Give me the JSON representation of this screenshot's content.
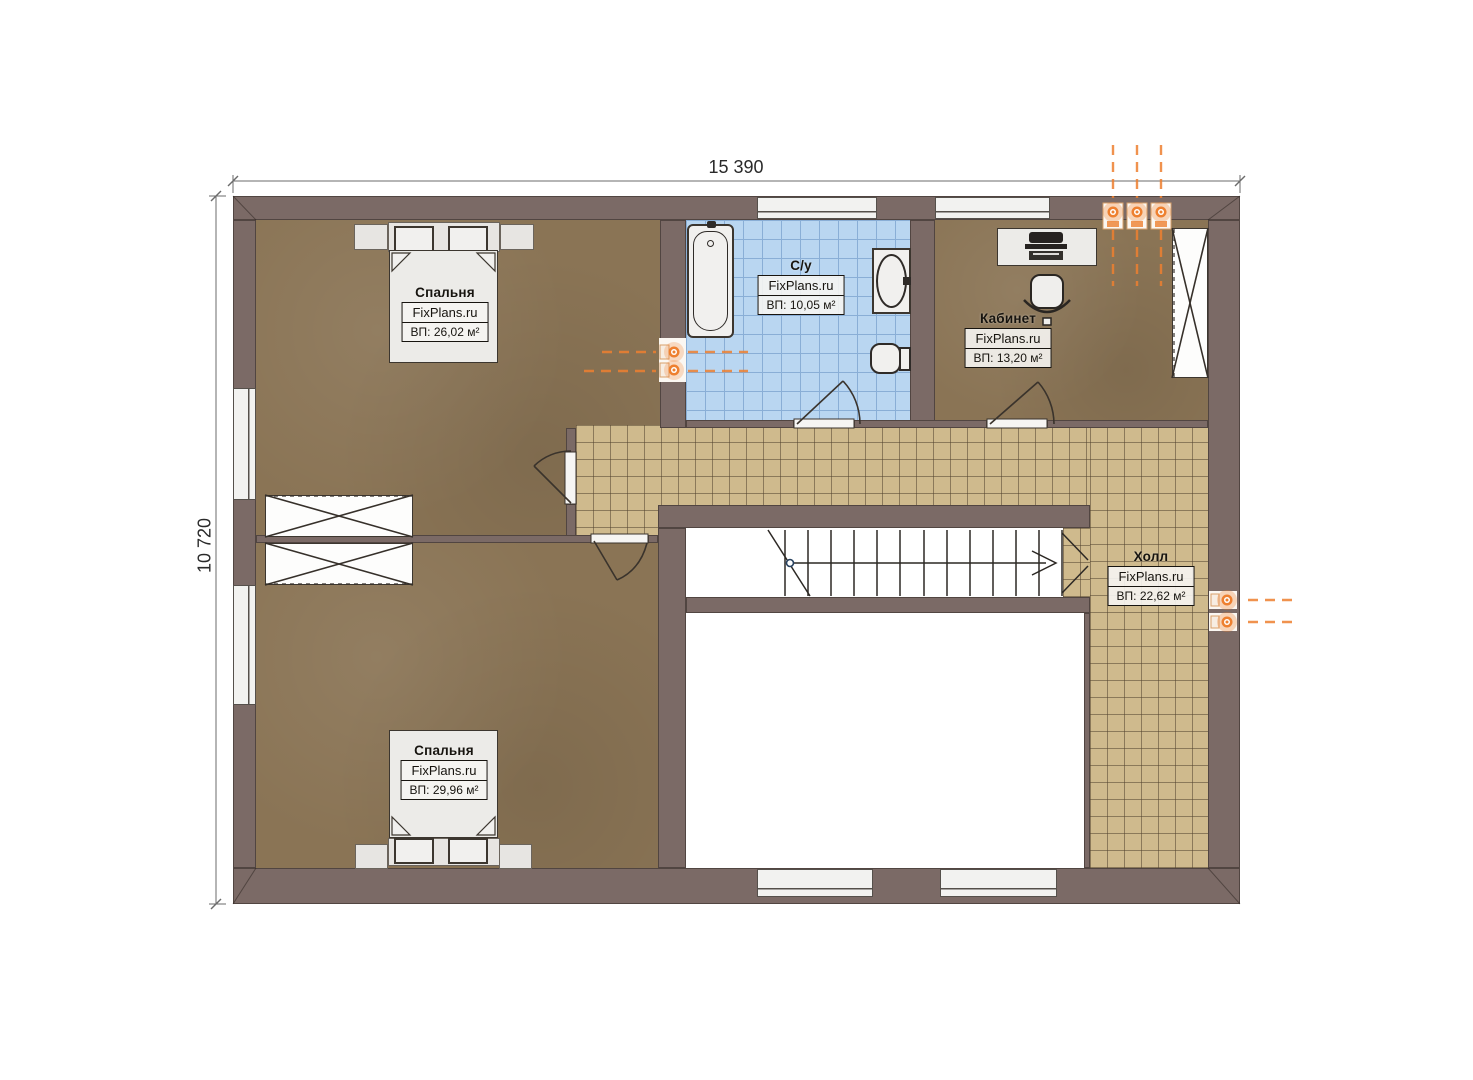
{
  "plan": {
    "type": "floor-plan",
    "dimension_labels": {
      "top": "15 390",
      "left": "10 720"
    },
    "rooms": [
      {
        "key": "bedroom-1",
        "name": "Спальня",
        "watermark": "FixPlans.ru",
        "area": "ВП: 26,02 м²"
      },
      {
        "key": "bathroom",
        "name": "С/у",
        "watermark": "FixPlans.ru",
        "area": "ВП: 10,05 м²"
      },
      {
        "key": "office",
        "name": "Кабинет",
        "watermark": "FixPlans.ru",
        "area": "ВП: 13,20 м²"
      },
      {
        "key": "hall",
        "name": "Холл",
        "watermark": "FixPlans.ru",
        "area": "ВП: 22,62 м²"
      },
      {
        "key": "bedroom-2",
        "name": "Спальня",
        "watermark": "FixPlans.ru",
        "area": "ВП: 29,96 м²"
      }
    ],
    "icons": {
      "radiator": "radiator-icon",
      "stairs": "stairs-up-arrow-icon",
      "wardrobe": "wardrobe-x-icon"
    },
    "colors": {
      "wall": "#7b6a66",
      "bedroom_floor": "#8a7455",
      "bath_tile": "#b9d6f1",
      "hall_tile": "#cfba8d",
      "accent_orange": "#ee8030"
    }
  }
}
